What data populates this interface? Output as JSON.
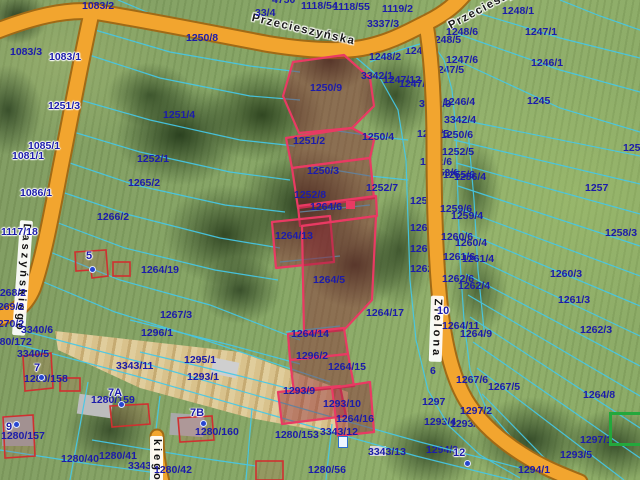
{
  "map": {
    "type": "cadastral-parcel-map",
    "streets": [
      {
        "label": "Przecieszyńska",
        "x": 253,
        "y": 13,
        "rot": 13,
        "style": "haloed"
      },
      {
        "label": "Przecieszyńska",
        "x": 447,
        "y": 22,
        "rot": -28,
        "style": "haloed"
      },
      {
        "label": "Daszyńskiego",
        "x": 33,
        "y": 221,
        "rot": 94,
        "style": "ribbon"
      },
      {
        "label": "Zielona",
        "x": 444,
        "y": 296,
        "rot": 92,
        "style": "ribbon"
      },
      {
        "label": "kiego",
        "x": 163,
        "y": 436,
        "rot": 90,
        "style": "ribbon"
      }
    ],
    "selected_parcels": [
      "1250/9",
      "1251/2",
      "1250/3",
      "1252/8",
      "1264/6",
      "1264/13",
      "1264/5",
      "1264/14",
      "1264/15",
      "1293/9",
      "1293/10"
    ],
    "green_highlight": {
      "x": 609,
      "y": 412,
      "w": 28,
      "h": 28
    },
    "parcel_labels": [
      {
        "t": "4750",
        "x": 272,
        "y": -5
      },
      {
        "t": "1083/2",
        "x": 82,
        "y": 1
      },
      {
        "t": "33/4",
        "x": 255,
        "y": 8
      },
      {
        "t": "1118/54",
        "x": 301,
        "y": 1
      },
      {
        "t": "1118/55",
        "x": 333,
        "y": 2
      },
      {
        "t": "1119/2",
        "x": 382,
        "y": 4
      },
      {
        "t": "1083/3",
        "x": 10,
        "y": 47
      },
      {
        "t": "1083/1",
        "x": 49,
        "y": 52,
        "h": 1
      },
      {
        "t": "1250/8",
        "x": 186,
        "y": 33
      },
      {
        "t": "3337/3",
        "x": 367,
        "y": 19
      },
      {
        "t": "1248/2",
        "x": 369,
        "y": 52
      },
      {
        "t": "1248",
        "x": 405,
        "y": 46,
        "u": 1
      },
      {
        "t": "3342/1",
        "x": 361,
        "y": 71
      },
      {
        "t": "1247/12",
        "x": 383,
        "y": 75
      },
      {
        "t": "1247/14",
        "x": 399,
        "y": 79,
        "u": 1
      },
      {
        "t": "1248/6",
        "x": 446,
        "y": 27
      },
      {
        "t": "1248/5",
        "x": 429,
        "y": 35,
        "u": 1
      },
      {
        "t": "1248/1",
        "x": 502,
        "y": 6
      },
      {
        "t": "1247/1",
        "x": 525,
        "y": 27
      },
      {
        "t": "1247/6",
        "x": 446,
        "y": 55
      },
      {
        "t": "1247/5",
        "x": 432,
        "y": 65,
        "u": 1
      },
      {
        "t": "1246/1",
        "x": 531,
        "y": 58
      },
      {
        "t": "1245",
        "x": 527,
        "y": 96
      },
      {
        "t": "1246/4",
        "x": 443,
        "y": 97
      },
      {
        "t": "3342/3",
        "x": 419,
        "y": 99,
        "u": 1
      },
      {
        "t": "3342/4",
        "x": 444,
        "y": 115
      },
      {
        "t": "125",
        "x": 623,
        "y": 143
      },
      {
        "t": "1251/4",
        "x": 163,
        "y": 110
      },
      {
        "t": "1251/3",
        "x": 48,
        "y": 101,
        "h": 1
      },
      {
        "t": "1085/1",
        "x": 28,
        "y": 141,
        "h": 1
      },
      {
        "t": "1081/1",
        "x": 12,
        "y": 151,
        "h": 1
      },
      {
        "t": "1086/1",
        "x": 20,
        "y": 188,
        "h": 1
      },
      {
        "t": "1252/1",
        "x": 137,
        "y": 154
      },
      {
        "t": "1265/2",
        "x": 128,
        "y": 178
      },
      {
        "t": "1266/2",
        "x": 97,
        "y": 212
      },
      {
        "t": "1117/18",
        "x": 1,
        "y": 227,
        "h": 1
      },
      {
        "t": "1264/19",
        "x": 141,
        "y": 265
      },
      {
        "t": "1250/9",
        "x": 310,
        "y": 83
      },
      {
        "t": "1251/2",
        "x": 293,
        "y": 136
      },
      {
        "t": "1250/4",
        "x": 362,
        "y": 132
      },
      {
        "t": "1250/3",
        "x": 307,
        "y": 166
      },
      {
        "t": "1252/7",
        "x": 366,
        "y": 183
      },
      {
        "t": "1252/8",
        "x": 294,
        "y": 190
      },
      {
        "t": "1264/6",
        "x": 310,
        "y": 202
      },
      {
        "t": "1264/13",
        "x": 275,
        "y": 231
      },
      {
        "t": "1264/5",
        "x": 313,
        "y": 275
      },
      {
        "t": "1264/17",
        "x": 366,
        "y": 308
      },
      {
        "t": "1250/5",
        "x": 417,
        "y": 129,
        "u": 1
      },
      {
        "t": "1250/6",
        "x": 441,
        "y": 130
      },
      {
        "t": "1252/5",
        "x": 442,
        "y": 147
      },
      {
        "t": "1252/6",
        "x": 420,
        "y": 157,
        "u": 1
      },
      {
        "t": "1253/6",
        "x": 427,
        "y": 168,
        "u": 1
      },
      {
        "t": "1255/6",
        "x": 443,
        "y": 170
      },
      {
        "t": "1256/4",
        "x": 454,
        "y": 172
      },
      {
        "t": "1259/5",
        "x": 410,
        "y": 196,
        "u": 1
      },
      {
        "t": "1259/6",
        "x": 440,
        "y": 204
      },
      {
        "t": "1259/4",
        "x": 451,
        "y": 211
      },
      {
        "t": "1260/5",
        "x": 410,
        "y": 223,
        "u": 1
      },
      {
        "t": "1260/6",
        "x": 441,
        "y": 232
      },
      {
        "t": "1260/4",
        "x": 455,
        "y": 238
      },
      {
        "t": "1261/5",
        "x": 410,
        "y": 244,
        "u": 1
      },
      {
        "t": "1261/6",
        "x": 443,
        "y": 252
      },
      {
        "t": "1261/4",
        "x": 462,
        "y": 254
      },
      {
        "t": "1262/5",
        "x": 410,
        "y": 264,
        "u": 1
      },
      {
        "t": "1262/6",
        "x": 442,
        "y": 274
      },
      {
        "t": "1262/4",
        "x": 458,
        "y": 281
      },
      {
        "t": "1257",
        "x": 585,
        "y": 183
      },
      {
        "t": "1258/3",
        "x": 605,
        "y": 228
      },
      {
        "t": "1260/3",
        "x": 550,
        "y": 269
      },
      {
        "t": "1261/3",
        "x": 558,
        "y": 295
      },
      {
        "t": "1262/3",
        "x": 580,
        "y": 325
      },
      {
        "t": "1264/11",
        "x": 442,
        "y": 321
      },
      {
        "t": "1264/9",
        "x": 460,
        "y": 329
      },
      {
        "t": "1267/6",
        "x": 456,
        "y": 375
      },
      {
        "t": "1267/5",
        "x": 488,
        "y": 382
      },
      {
        "t": "6",
        "x": 430,
        "y": 366
      },
      {
        "t": "1267/3",
        "x": 160,
        "y": 310
      },
      {
        "t": "1296/1",
        "x": 141,
        "y": 328
      },
      {
        "t": "1295/1",
        "x": 184,
        "y": 355
      },
      {
        "t": "1293/1",
        "x": 187,
        "y": 372
      },
      {
        "t": "3343/11",
        "x": 116,
        "y": 361
      },
      {
        "t": "1268/2",
        "x": -6,
        "y": 288
      },
      {
        "t": "1269/2",
        "x": -8,
        "y": 302
      },
      {
        "t": "1270/2",
        "x": -8,
        "y": 319
      },
      {
        "t": "3340/6",
        "x": 21,
        "y": 325
      },
      {
        "t": "1280/172",
        "x": -12,
        "y": 337
      },
      {
        "t": "3340/5",
        "x": 17,
        "y": 349
      },
      {
        "t": "1280/158",
        "x": 24,
        "y": 374
      },
      {
        "t": "1280/157",
        "x": 1,
        "y": 431
      },
      {
        "t": "1280/40",
        "x": 61,
        "y": 454
      },
      {
        "t": "1280/41",
        "x": 99,
        "y": 451
      },
      {
        "t": "3343/14",
        "x": 128,
        "y": 461,
        "u": 1
      },
      {
        "t": "1280/42",
        "x": 154,
        "y": 465
      },
      {
        "t": "1280/159",
        "x": 91,
        "y": 395
      },
      {
        "t": "1280/160",
        "x": 195,
        "y": 427
      },
      {
        "t": "1264/14",
        "x": 291,
        "y": 329
      },
      {
        "t": "1296/2",
        "x": 296,
        "y": 351
      },
      {
        "t": "1264/15",
        "x": 328,
        "y": 362
      },
      {
        "t": "1293/9",
        "x": 283,
        "y": 386
      },
      {
        "t": "1293/10",
        "x": 323,
        "y": 399
      },
      {
        "t": "1264/16",
        "x": 336,
        "y": 414
      },
      {
        "t": "1280/153",
        "x": 275,
        "y": 430
      },
      {
        "t": "3343/12",
        "x": 320,
        "y": 427
      },
      {
        "t": "1280/56",
        "x": 308,
        "y": 465
      },
      {
        "t": "3343/13",
        "x": 368,
        "y": 447
      },
      {
        "t": "1294/1",
        "x": 518,
        "y": 465
      },
      {
        "t": "1293/5",
        "x": 560,
        "y": 450
      },
      {
        "t": "1297/1",
        "x": 580,
        "y": 435
      },
      {
        "t": "1264/8",
        "x": 583,
        "y": 390
      },
      {
        "t": "1297/2",
        "x": 460,
        "y": 406
      },
      {
        "t": "1297",
        "x": 422,
        "y": 397
      },
      {
        "t": "1293/4",
        "x": 424,
        "y": 417,
        "u": 1
      },
      {
        "t": "1293/6",
        "x": 450,
        "y": 419,
        "u": 1
      },
      {
        "t": "1294/3",
        "x": 426,
        "y": 445,
        "u": 1
      }
    ],
    "house_numbers": [
      {
        "t": "5",
        "x": 86,
        "y": 251,
        "dx": 89,
        "dy": 266
      },
      {
        "t": "7",
        "x": 34,
        "y": 363,
        "dx": 38,
        "dy": 374
      },
      {
        "t": "7A",
        "x": 108,
        "y": 388,
        "dx": 118,
        "dy": 401
      },
      {
        "t": "7B",
        "x": 190,
        "y": 408,
        "dx": 200,
        "dy": 420
      },
      {
        "t": "9",
        "x": 6,
        "y": 422,
        "dx": 13,
        "dy": 421
      },
      {
        "t": "10",
        "x": 437,
        "y": 306
      },
      {
        "t": "12",
        "x": 453,
        "y": 448,
        "dx": 464,
        "dy": 460
      }
    ],
    "colors": {
      "parcel_line": "#45c8e8",
      "parcel_text": "#1c1caa",
      "road_fill": "#f2a52f",
      "road_casing": "#a06a16",
      "selected_stroke": "#e93a63",
      "selected_fill": "rgba(140,30,50,0.42)",
      "building_stroke": "#d03030",
      "green_highlight": "#23a83c"
    }
  }
}
